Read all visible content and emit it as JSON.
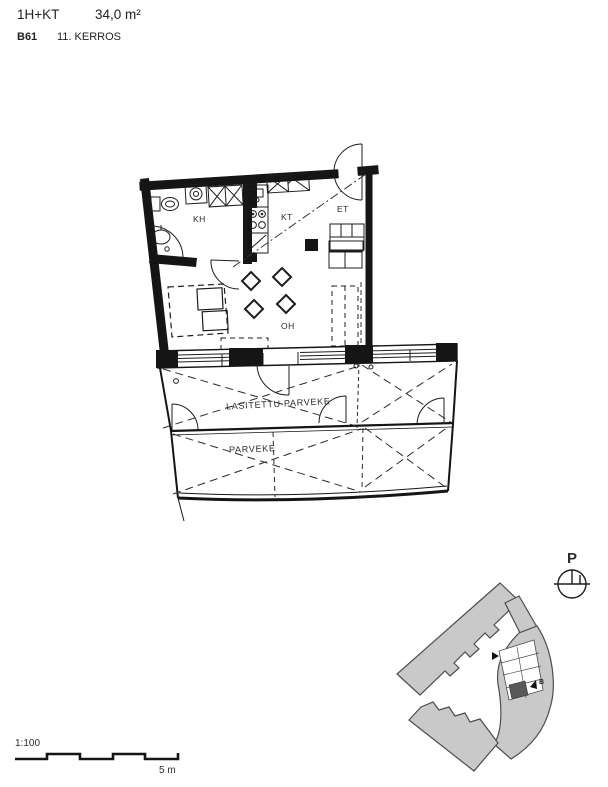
{
  "header": {
    "layout": "1H+KT",
    "area": "34,0 m²",
    "unit_id": "B61",
    "floor": "11. KERROS"
  },
  "floor_plan": {
    "rooms": {
      "kh": "KH",
      "kt": "KT",
      "et": "ET",
      "oh": "OH"
    },
    "balcony": {
      "glazed_label": "LASITETTU PARVEKE",
      "open_label": "PARVEKE"
    }
  },
  "site_plan": {
    "north_label": "P",
    "building_label": "B"
  },
  "scale": {
    "ratio": "1:100",
    "bar_label": "5 m"
  },
  "colors": {
    "ink": "#1d1d1d",
    "building_fill": "#c9c9c9",
    "building_stroke": "#4d4d4d",
    "highlighted_unit": "#595959",
    "background": "#ffffff"
  }
}
